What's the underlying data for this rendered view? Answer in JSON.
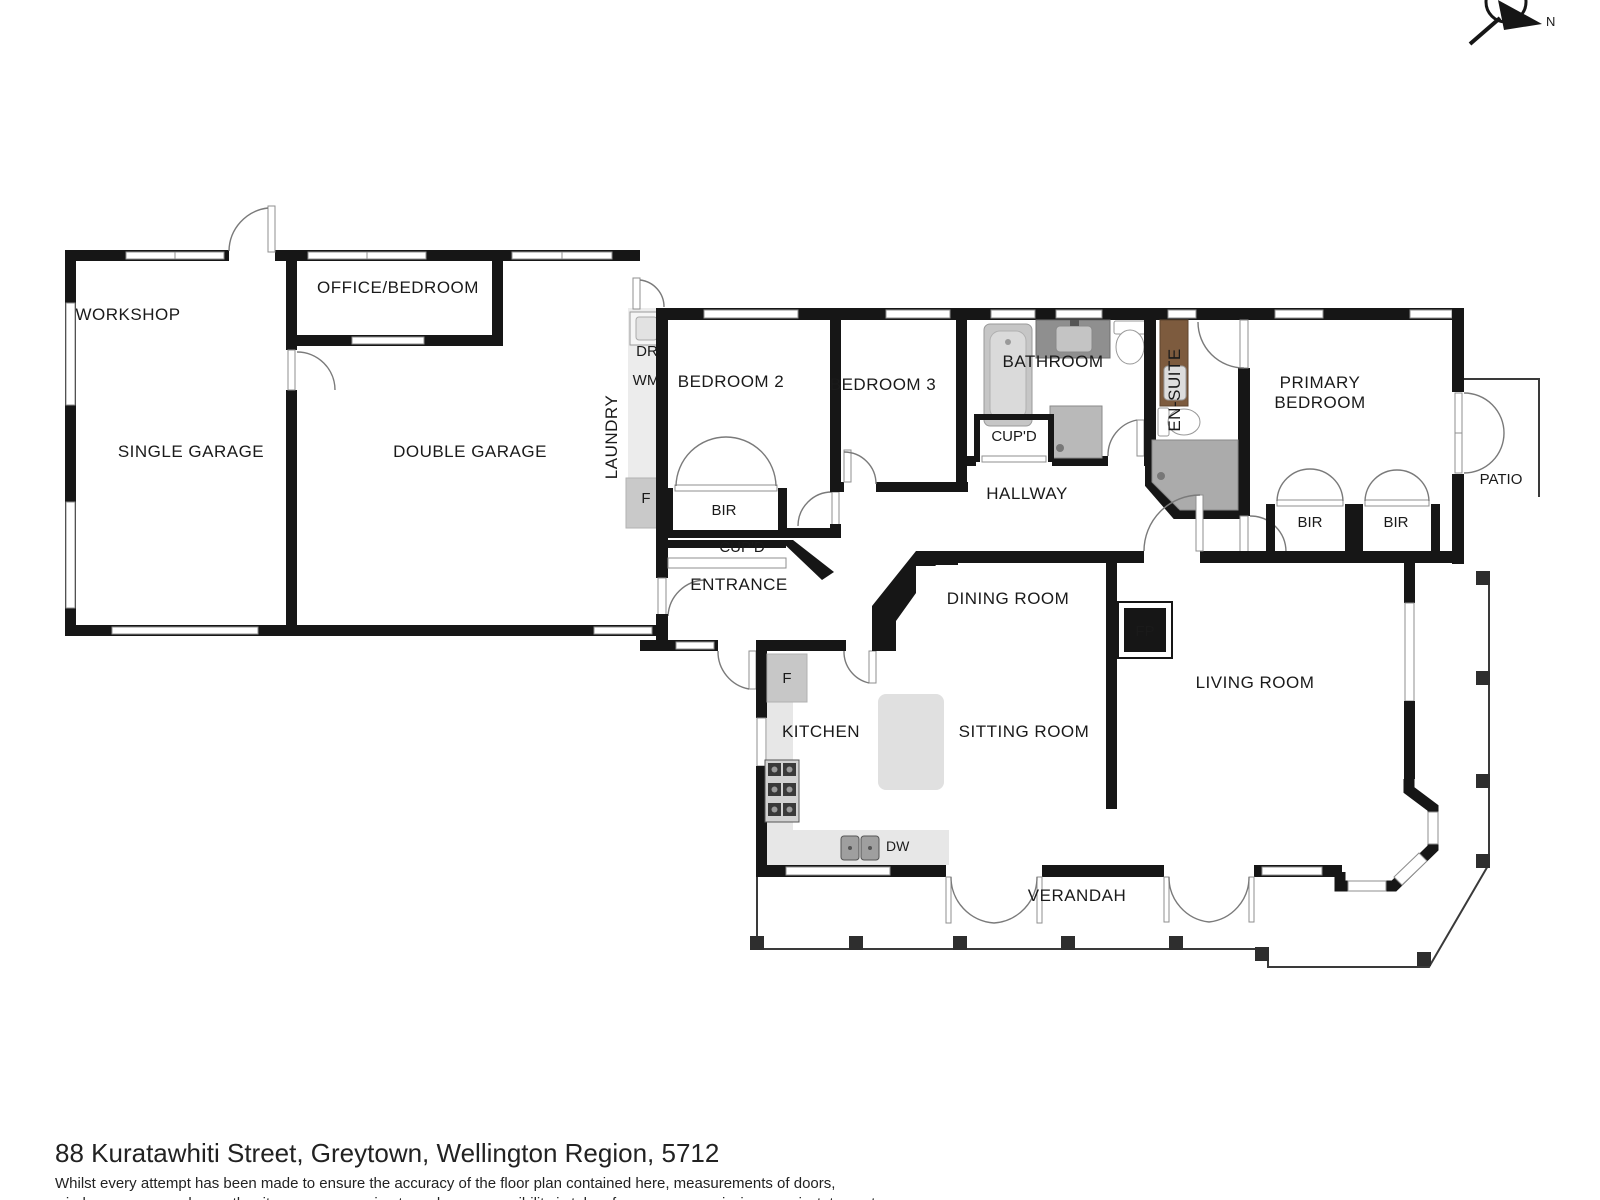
{
  "compass": {
    "label": "N"
  },
  "rooms": {
    "workshop": "WORKSHOP",
    "single_garage": "SINGLE GARAGE",
    "office_bedroom": "OFFICE/BEDROOM",
    "double_garage": "DOUBLE GARAGE",
    "laundry": "LAUNDRY",
    "bedroom2": "BEDROOM 2",
    "bedroom3": "BEDROOM 3",
    "bathroom": "BATHROOM",
    "ensuite": "EN-SUITE",
    "primary_bedroom_line1": "PRIMARY",
    "primary_bedroom_line2": "BEDROOM",
    "patio": "PATIO",
    "hallway": "HALLWAY",
    "entrance": "ENTRANCE",
    "dining_room": "DINING ROOM",
    "living_room": "LIVING ROOM",
    "kitchen": "KITCHEN",
    "sitting_room": "SITTING ROOM",
    "verandah": "VERANDAH"
  },
  "fixtures": {
    "dryer": "DR",
    "washing_machine": "WM",
    "freezer_laundry": "F",
    "fridge_kitchen": "F",
    "dishwasher": "DW",
    "fireplace": "FP",
    "bir_bedroom2": "BIR",
    "bir_primary_left": "BIR",
    "bir_primary_right": "BIR",
    "cupd_hall": "CUP'D",
    "cupd_entrance": "CUP'D"
  },
  "footer": {
    "title": "88 Kuratawhiti Street, Greytown, Wellington Region, 5712",
    "disclaimer_line1": "Whilst every attempt has been made to ensure the accuracy of the floor plan contained here, measurements of doors,",
    "disclaimer_line2": "windows, rooms and any other items are approximate and no responsibility is taken for any error, omission, or misstatement."
  },
  "colors": {
    "wall": "#161616",
    "counter": "#e7e7e7",
    "fixture_gray": "#c6c6c6",
    "shower_gray": "#ababab",
    "vanity_brown": "#7d5b3e"
  }
}
